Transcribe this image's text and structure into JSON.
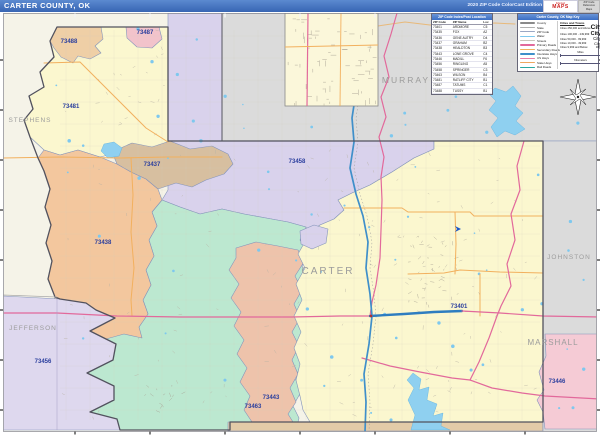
{
  "header": {
    "title": "CARTER COUNTY, OK",
    "edition": "2020 ZIP Code ColorCast Edition",
    "logo": {
      "brand_top": "Market",
      "brand_bottom": "MAPS",
      "box_line1": "ZIP Code",
      "box_line2": "Reference",
      "box_line3": "Maps"
    },
    "bar_color": "#3f6fbe"
  },
  "zip_table": {
    "title": "ZIP Code Index/Post Location",
    "columns": [
      "ZIP Code",
      "ZIP Name",
      "Loc"
    ],
    "rows": [
      [
        "73401",
        "ARDMORE",
        "C5"
      ],
      [
        "73435",
        "FOX",
        "A2"
      ],
      [
        "73436",
        "GENE AUTRY",
        "D4"
      ],
      [
        "73437",
        "GRAHAM",
        "B2"
      ],
      [
        "73438",
        "HEALDTON",
        "B3"
      ],
      [
        "73443",
        "LONE GROVE",
        "C4"
      ],
      [
        "73446",
        "MADILL",
        "F6"
      ],
      [
        "73456",
        "RINGLING",
        "A5"
      ],
      [
        "73458",
        "SPRINGER",
        "C3"
      ],
      [
        "73463",
        "WILSON",
        "B4"
      ],
      [
        "73481",
        "RATLIFF CITY",
        "B1"
      ],
      [
        "73487",
        "TATUMS",
        "C1"
      ],
      [
        "73488",
        "TUSSY",
        "B1"
      ]
    ]
  },
  "legend": {
    "title": "Carter County, OK Map Key",
    "line_items": [
      {
        "label": "County",
        "color": "#8a8a8a",
        "w": 2.2
      },
      {
        "label": "State",
        "color": "#b0b0b0",
        "w": 1.6
      },
      {
        "label": "ZIP Code",
        "color": "#9aa7c4",
        "w": 1
      },
      {
        "label": "Water",
        "color": "#7ec8ee",
        "w": 1.6
      },
      {
        "label": "Streets",
        "color": "#c9c5ba",
        "w": 1
      },
      {
        "label": "Primary Roads",
        "color": "#e2699b",
        "w": 1.6
      },
      {
        "label": "Secondary Roads",
        "color": "#f2b05e",
        "w": 1.6
      },
      {
        "label": "Interstate Hwys",
        "color": "#3f8fca",
        "w": 2
      },
      {
        "label": "US Hwys",
        "color": "#e87fa8",
        "w": 1.6
      },
      {
        "label": "State Hwys",
        "color": "#f0a860",
        "w": 1.4
      },
      {
        "label": "Rail Roads",
        "color": "#2aa8a0",
        "w": 1
      }
    ],
    "cities_title": "Cities and Towns",
    "city_items": [
      {
        "label": "Cities 250,000 and Above",
        "sample": "City",
        "size": 6.5,
        "bold": true
      },
      {
        "label": "Cities 100,000 - 249,999",
        "sample": "City",
        "size": 5.5,
        "bold": true
      },
      {
        "label": "Cities 50,000 - 99,999",
        "sample": "City",
        "size": 4.6,
        "bold": false
      },
      {
        "label": "Cities 10,000 - 49,999",
        "sample": "City",
        "size": 4,
        "bold": false
      },
      {
        "label": "Cities 9,999 and Below",
        "sample": "city",
        "size": 3.4,
        "bold": false
      }
    ],
    "scales": [
      {
        "label": "Miles"
      },
      {
        "label": "Kilometers"
      }
    ]
  },
  "map": {
    "colors": {
      "outside": "#f5f3e8",
      "county_gray": "#dbdbdb",
      "yellow": "#fbf7cf",
      "peach": "#efcfa6",
      "pink": "#f2c3cb",
      "taupe": "#d7bfa0",
      "orange": "#f3c79e",
      "mint": "#bce8d0",
      "salmon": "#eec3ab",
      "lavender": "#d9d2ec",
      "lavender2": "#ded8ee",
      "marshall_pink": "#f5cbd5",
      "tan_strip": "#e3cba8",
      "water": "#8fd0f0",
      "zip_border": "#8494bb",
      "county_border": "#52525e",
      "zip_label": "#2b3f9e",
      "county_label": "#9c9c9c"
    },
    "regions": [
      {
        "id": "garvin-strip-73433",
        "color": "lavender",
        "points": "168,13 222,13 222,141 434,141 434,149 414,158 392,172 370,185 352,193 338,200 344,210 334,219 320,225 310,232 306,227 288,222 266,218 244,214 222,209 200,214 180,207 162,200 168,190"
      },
      {
        "id": "zip-73481",
        "color": "yellow",
        "points": "57,27 168,27 168,141 150,158 128,150 100,157 78,150 60,155 44,150 30,137 24,120 33,109 29,96 44,87 40,72 54,57 50,41"
      },
      {
        "id": "zip-73488",
        "color": "peach",
        "points": "57,27 101,27 103,39 95,46 101,53 90,59 78,56 73,63 61,57 54,48 50,41"
      },
      {
        "id": "zip-73487",
        "color": "pink",
        "points": "126,27 159,27 162,39 152,48 137,47 127,38"
      },
      {
        "id": "zip-73463",
        "color": "mint",
        "points": "162,200 180,207 200,214 222,209 244,214 266,218 288,222 306,227 300,240 310,252 302,266 309,280 300,294 306,308 298,322 304,336 296,350 302,364 295,378 301,392 293,406 299,418 296,430 120,430 117,419 90,412 114,400 114,386 87,373 113,360 116,344 90,331 115,318 96,310 110,305 126,300 139,327 148,314 143,300 151,285 146,270 154,256 149,240 157,226 152,212"
      },
      {
        "id": "zip-73438",
        "color": "orange",
        "points": "44,150 60,155 78,150 100,157 117,164 131,172 146,179 158,189 162,200 152,212 157,226 149,240 154,256 146,270 151,285 143,300 148,314 139,327 142,338 124,334 106,339 88,333 70,337 56,333 51,315 55,297 48,279 52,261 46,243 51,225 45,207 50,189 44,171 38,158"
      },
      {
        "id": "zip-73437",
        "color": "taupe",
        "points": "112,152 132,143 152,147 170,141 190,149 212,146 228,154 233,164 224,174 206,180 192,187 176,183 158,189 146,179 131,172 117,164"
      },
      {
        "id": "zip-73443",
        "color": "salmon",
        "points": "236,248 256,242 278,246 298,250 304,262 295,276 302,290 294,304 300,318 292,332 299,346 292,360 298,374 290,388 296,402 288,414 293,422 252,422 244,410 250,396 240,382 247,368 237,354 244,340 234,326 241,312 231,298 239,284 229,270 236,258"
      },
      {
        "id": "zip-73401",
        "color": "yellow",
        "points": "310,232 320,225 334,219 344,210 338,200 352,193 370,185 392,172 414,158 434,149 434,141 543,141 543,422 310,422 303,410 300,396 296,380 300,364 294,348 301,332 294,316 302,300 296,284 305,268 298,254 306,240"
      },
      {
        "id": "zip-73436",
        "color": "lavender",
        "points": "300,231 314,225 328,229 326,243 312,249 301,244"
      },
      {
        "id": "zip-73456",
        "color": "lavender2",
        "points": "3,296 60,299 86,303 96,310 115,318 90,331 116,344 113,360 87,373 114,386 114,400 90,412 117,419 120,430 3,430"
      },
      {
        "id": "love-strip",
        "color": "tan_strip",
        "points": "228,422 543,422 543,431 228,431"
      },
      {
        "id": "north-gray",
        "color": "county_gray",
        "points": "222,13 600,13 600,141 222,141"
      },
      {
        "id": "east-gray",
        "color": "county_gray",
        "points": "543,141 600,141 600,432 543,432"
      },
      {
        "id": "zip-73446",
        "color": "marshall_pink",
        "points": "545,334 597,334 597,429 545,429 543,412 537,400 544,390 539,372 546,356"
      }
    ],
    "lakes": [
      {
        "id": "lake-arbuckle",
        "points": "495,88 506,92 513,86 521,96 515,106 523,113 516,121 525,129 515,135 505,131 497,137 491,127 498,118 489,110 496,101 489,94"
      },
      {
        "id": "lake-murray",
        "points": "413,373 421,379 419,390 429,387 427,400 437,404 433,416 443,413 441,426 450,430 411,430 415,415 408,400 414,388 407,380"
      },
      {
        "id": "small-lake",
        "points": "104,144 114,142 122,148 119,156 108,158 101,151"
      }
    ],
    "roads": [
      {
        "id": "hwy-53",
        "color": "#f2b05e",
        "w": 1.1,
        "points": "3,158 60,157 120,158 168,157 222,157"
      },
      {
        "id": "hwy-nw-diagonal",
        "color": "#f2b05e",
        "w": 1,
        "points": "44,63 80,62 100,82 122,104 146,128 168,142"
      },
      {
        "id": "hwy-76",
        "color": "#f2b05e",
        "w": 1,
        "points": "131,158 133,195 131,232 134,268 131,300 132,316"
      },
      {
        "id": "hwy-orange-e1",
        "color": "#f2b05e",
        "w": 1,
        "points": "344,208 402,208 408,212 470,212 474,216 543,216"
      },
      {
        "id": "hwy-orange-e2",
        "color": "#f2b05e",
        "w": 1,
        "points": "408,274 444,273 460,270 500,272 543,273"
      },
      {
        "id": "hwy-orange-e3",
        "color": "#f2b05e",
        "w": 1,
        "points": "455,212 456,244 455,274"
      },
      {
        "id": "hwy-orange-e4",
        "color": "#f2b05e",
        "w": 1,
        "points": "480,274 480,316"
      },
      {
        "id": "hwy-orange-top",
        "color": "#e8b97a",
        "w": 1,
        "points": "378,26 405,22 430,25 495,23 515,24"
      },
      {
        "id": "rail-line",
        "color": "#9a9a9a",
        "w": 0.5,
        "dash": "1,2.5",
        "points": "375,13 372,38 366,66 360,92 356,118 358,142 354,168 360,194 367,216 372,242 370,268 374,294 376,316 373,344 368,374 370,402 369,432"
      },
      {
        "id": "us-77",
        "color": "#e2699b",
        "w": 1.2,
        "points": "397,13 391,34 384,56 389,77 381,97 386,117 379,137 384,157 381,177 382,200 381,230 380,258 376,285 372,302 370,316"
      },
      {
        "id": "us-177",
        "color": "#e2699b",
        "w": 1.2,
        "points": "524,141 517,166 520,190 511,214 515,240 507,264 511,286 501,306 497,316 489,338 479,362 470,380"
      },
      {
        "id": "hwy-77s",
        "color": "#e2699b",
        "w": 1.2,
        "points": "362,358 390,366 420,372 452,378 470,380 492,388 522,393 545,396 600,399"
      },
      {
        "id": "us-70-west",
        "color": "#e2699b",
        "w": 1.2,
        "points": "3,313 57,313 117,316 180,317 236,317 292,317 340,316 372,316"
      },
      {
        "id": "us-70-blue",
        "color": "#2e7dc0",
        "w": 2.4,
        "points": "370,316 404,314 434,312 462,311"
      },
      {
        "id": "us-70-east",
        "color": "#e2699b",
        "w": 1.2,
        "points": "462,311 500,313 543,316 600,317"
      },
      {
        "id": "i-35",
        "color": "#3f8fca",
        "w": 1.7,
        "points": "371,13 368,38 362,66 356,92 352,118 354,142 350,168 356,194 363,216 368,242 366,268 370,294 372,316 369,344 364,374 366,402 365,432"
      }
    ],
    "county_border": "M57,27 L50,41 L54,57 L40,72 L44,87 L29,96 L33,109 L24,120 L30,137 L38,158 L44,171 L50,189 L45,207 L51,225 L46,243 L52,261 L48,279 L55,297 L60,299 L86,303 L96,310 L115,318 L90,331 L116,344 L113,360 L87,373 L114,386 L114,400 L90,412 L117,419 L120,430 L230,430 L230,422 L543,422 L543,141 L168,141 L168,27 Z",
    "extra_borders": [
      {
        "id": "garvin-murray-line",
        "color": "#55555f",
        "w": 1,
        "points": "222,13 222,141"
      },
      {
        "id": "stephens-jefferson-line",
        "color": "#aaaaaa",
        "w": 0.7,
        "points": "3,295 57,297"
      },
      {
        "id": "jefferson-zip-line",
        "color": "#a8a0c8",
        "w": 0.5,
        "points": "57,299 57,430"
      }
    ],
    "county_labels": [
      {
        "text": "STEPHENS",
        "x": 30,
        "y": 122,
        "size": 6.5
      },
      {
        "text": "JEFFERSON",
        "x": 33,
        "y": 330,
        "size": 6.5
      },
      {
        "text": "MURRAY",
        "x": 406,
        "y": 83,
        "size": 8.5
      },
      {
        "text": "CARTER",
        "x": 328,
        "y": 274,
        "size": 10
      },
      {
        "text": "JOHNSTON",
        "x": 569,
        "y": 259,
        "size": 6.5
      },
      {
        "text": "MARSHALL",
        "x": 553,
        "y": 345,
        "size": 8
      }
    ],
    "zip_labels": [
      {
        "text": "73488",
        "x": 69,
        "y": 43
      },
      {
        "text": "73487",
        "x": 145,
        "y": 34
      },
      {
        "text": "73481",
        "x": 71,
        "y": 108
      },
      {
        "text": "73437",
        "x": 152,
        "y": 166
      },
      {
        "text": "73438",
        "x": 103,
        "y": 244
      },
      {
        "text": "73458",
        "x": 297,
        "y": 163
      },
      {
        "text": "73401",
        "x": 459,
        "y": 308
      },
      {
        "text": "73443",
        "x": 271,
        "y": 399
      },
      {
        "text": "73463",
        "x": 253,
        "y": 408
      },
      {
        "text": "73456",
        "x": 43,
        "y": 363
      },
      {
        "text": "73446",
        "x": 557,
        "y": 383
      }
    ],
    "inset": {
      "x": 285,
      "y": 13,
      "w": 93,
      "h": 93,
      "bg": "#fbf7da"
    }
  }
}
